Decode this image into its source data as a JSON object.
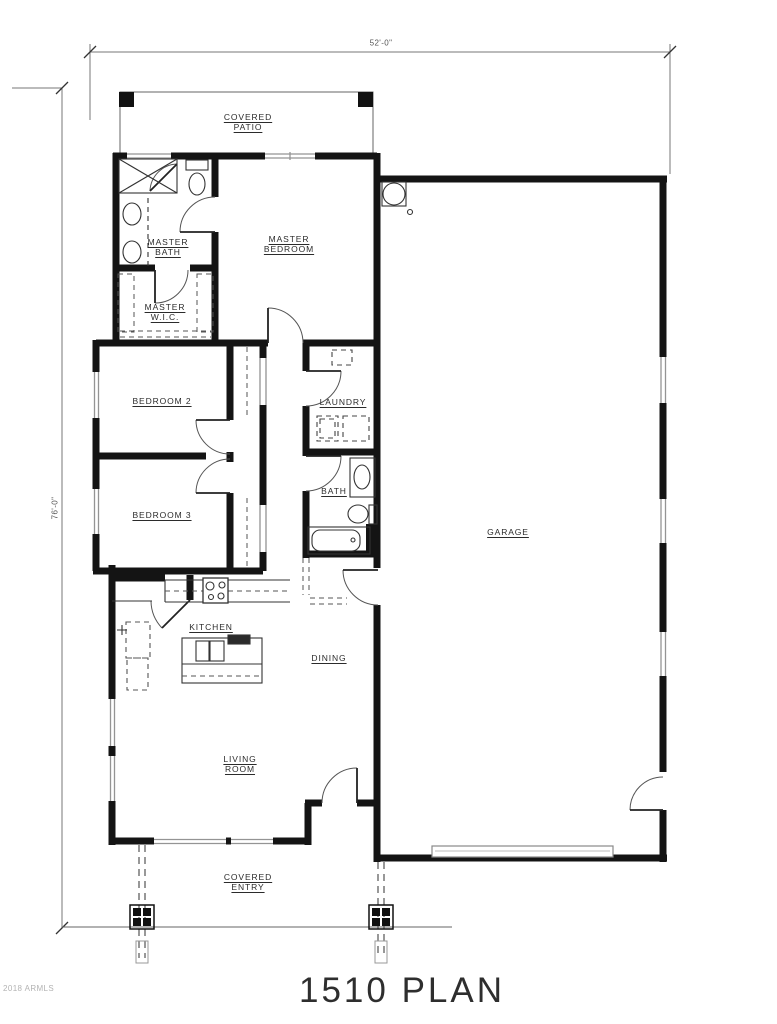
{
  "meta": {
    "plan_title": "1510 PLAN",
    "watermark": "2018 ARMLS"
  },
  "dimensions": {
    "overall_width": "52'-0\"",
    "overall_depth": "76'-0\""
  },
  "rooms": {
    "covered_patio": "COVERED\nPATIO",
    "master_bath": "MASTER\nBATH",
    "master_bedroom": "MASTER\nBEDROOM",
    "master_wic": "MASTER\nW.I.C.",
    "bedroom_2": "BEDROOM 2",
    "laundry": "LAUNDRY",
    "bedroom_3": "BEDROOM 3",
    "bath": "BATH",
    "garage": "GARAGE",
    "kitchen": "KITCHEN",
    "dining": "DINING",
    "living_room": "LIVING\nROOM",
    "covered_entry": "COVERED\nENTRY"
  },
  "fixtures": [
    "shower",
    "toilet",
    "vanity-sinks",
    "closet-shelves",
    "washer",
    "dryer",
    "cabinet",
    "bath-sink",
    "bathtub",
    "stove",
    "kitchen-counter",
    "kitchen-island",
    "island-sink",
    "refrigerator",
    "pantry-door",
    "water-heater",
    "garage-door",
    "entry-posts",
    "post-footings"
  ],
  "colors": {
    "wall": "#141414",
    "thin_line": "#333333",
    "window": "#949494",
    "dashed": "#555555",
    "dimension": "#666666",
    "label_text": "#2b2b2b",
    "watermark_text": "#b3b3b3",
    "background": "#ffffff"
  }
}
